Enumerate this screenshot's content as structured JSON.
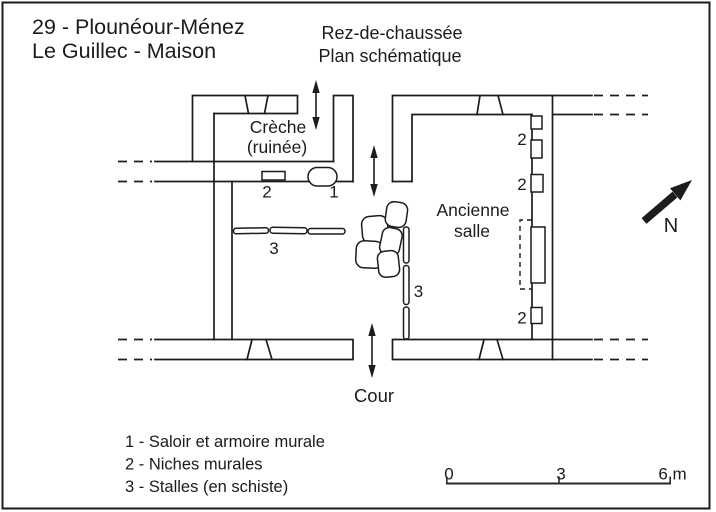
{
  "colors": {
    "ink": "#1c1c1c",
    "paper": "#ffffff"
  },
  "header": {
    "site_line1": "29 - Plounéour-Ménez",
    "site_line2": "Le Guillec - Maison",
    "plan_level": "Rez-de-chaussée",
    "plan_type": "Plan schématique"
  },
  "plan": {
    "rooms": {
      "creche": {
        "line1": "Crèche",
        "line2": "(ruinée)"
      },
      "ancienne_salle": {
        "line1": "Ancienne",
        "line2": "salle"
      }
    },
    "outside": {
      "courtyard": "Cour"
    },
    "compass": {
      "north": "N"
    },
    "markers": {
      "saloir": "1",
      "niche_creche_wall": "2",
      "stalls_row": "3",
      "stalls_column": "3",
      "niche_east_top": "2",
      "niche_east_middle": "2",
      "niche_east_bottom": "2"
    }
  },
  "legend": {
    "items": [
      "1 - Saloir et armoire murale",
      "2 - Niches murales",
      "3 - Stalles (en schiste)"
    ]
  },
  "scale_bar": {
    "labels": [
      "0",
      "3",
      "6 m"
    ]
  }
}
